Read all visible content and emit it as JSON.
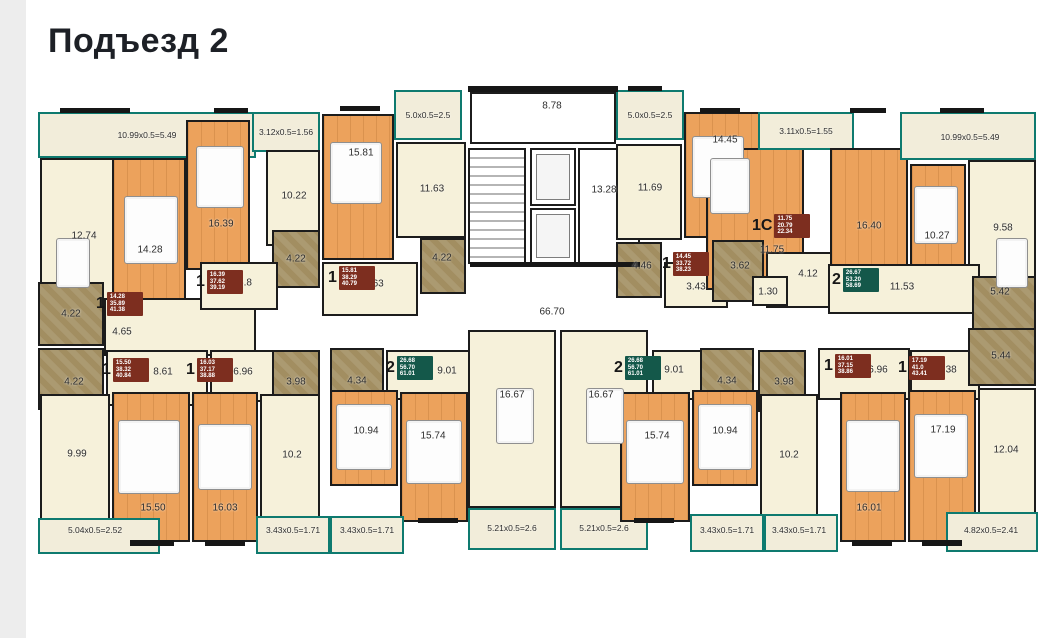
{
  "title": "Подъезд 2",
  "colors": {
    "teal_outline": "#0e7a6f",
    "wood_floor": "#eca25c",
    "kitchen_hall": "#f6f1da",
    "bathroom": "#a28e61",
    "wall": "#161616",
    "badge_red": "#7d2e1f",
    "badge_green": "#14584a"
  },
  "plan": {
    "rooms": [
      {
        "n": "balcony-a1",
        "l": "10.99x0.5=5.49",
        "t": "balcony",
        "x": 38,
        "y": 112,
        "w": 218,
        "h": 46
      },
      {
        "n": "kitchen-a1",
        "l": "12.74",
        "t": "cream",
        "x": 40,
        "y": 158,
        "w": 84,
        "h": 182,
        "lx": 84,
        "ly": 236
      },
      {
        "n": "bedroom-a1",
        "l": "14.28",
        "t": "wood",
        "x": 112,
        "y": 158,
        "w": 74,
        "h": 152,
        "lx": 150,
        "ly": 250
      },
      {
        "n": "hall-a1",
        "l": "4.65",
        "t": "cream",
        "x": 104,
        "y": 298,
        "w": 152,
        "h": 58,
        "lx": 122,
        "ly": 332
      },
      {
        "n": "bath-a1",
        "l": "4.22",
        "t": "bath",
        "x": 38,
        "y": 282,
        "w": 66,
        "h": 64
      },
      {
        "n": "bedroom-a2",
        "l": "16.39",
        "t": "wood",
        "x": 186,
        "y": 120,
        "w": 64,
        "h": 150,
        "lx": 221,
        "ly": 224
      },
      {
        "n": "balcony-a2",
        "l": "3.12x0.5=1.56",
        "t": "balcony",
        "x": 252,
        "y": 112,
        "w": 68,
        "h": 40
      },
      {
        "n": "kitchen-a2",
        "l": "10.22",
        "t": "cream",
        "x": 266,
        "y": 150,
        "w": 54,
        "h": 96,
        "lx": 294,
        "ly": 196
      },
      {
        "n": "bath-a2",
        "l": "4.22",
        "t": "bath",
        "x": 272,
        "y": 230,
        "w": 48,
        "h": 58
      },
      {
        "n": "hall-a2",
        "l": "6.8",
        "t": "cream",
        "x": 200,
        "y": 262,
        "w": 78,
        "h": 48,
        "lx": 245,
        "ly": 283
      },
      {
        "n": "bedroom-a3",
        "l": "15.81",
        "t": "wood",
        "x": 322,
        "y": 114,
        "w": 72,
        "h": 146,
        "lx": 361,
        "ly": 153
      },
      {
        "n": "balcony-a3",
        "l": "5.0x0.5=2.5",
        "t": "balcony",
        "x": 394,
        "y": 90,
        "w": 68,
        "h": 50
      },
      {
        "n": "kitchen-a3",
        "l": "11.63",
        "t": "cream",
        "x": 396,
        "y": 142,
        "w": 70,
        "h": 96,
        "lx": 432,
        "ly": 189
      },
      {
        "n": "bath-a3",
        "l": "4.22",
        "t": "bath",
        "x": 420,
        "y": 238,
        "w": 46,
        "h": 56,
        "lx": 442,
        "ly": 258
      },
      {
        "n": "hall-a3",
        "l": "6.63",
        "t": "cream",
        "x": 322,
        "y": 262,
        "w": 96,
        "h": 54,
        "lx": 374,
        "ly": 284
      },
      {
        "n": "entry-vestibule",
        "l": "8.78",
        "t": "core",
        "x": 470,
        "y": 92,
        "w": 146,
        "h": 52,
        "lx": 552,
        "ly": 106
      },
      {
        "n": "stairwell",
        "l": "",
        "t": "stairs",
        "x": 468,
        "y": 148,
        "w": 58,
        "h": 116
      },
      {
        "n": "elevator-1",
        "l": "",
        "t": "elevator",
        "x": 530,
        "y": 148,
        "w": 46,
        "h": 58
      },
      {
        "n": "elevator-2",
        "l": "",
        "t": "elevator",
        "x": 530,
        "y": 208,
        "w": 46,
        "h": 56
      },
      {
        "n": "elevator-hall",
        "l": "13.28",
        "t": "core",
        "x": 578,
        "y": 148,
        "w": 62,
        "h": 116,
        "lx": 604,
        "ly": 190
      },
      {
        "n": "balcony-a4",
        "l": "5.0x0.5=2.5",
        "t": "balcony",
        "x": 616,
        "y": 90,
        "w": 68,
        "h": 50
      },
      {
        "n": "kitchen-a4",
        "l": "11.69",
        "t": "cream",
        "x": 616,
        "y": 144,
        "w": 66,
        "h": 96,
        "lx": 650,
        "ly": 188
      },
      {
        "n": "bedroom-a4",
        "l": "14.45",
        "t": "wood",
        "x": 684,
        "y": 112,
        "w": 76,
        "h": 126,
        "lx": 725,
        "ly": 140
      },
      {
        "n": "bath-a4",
        "l": "4.46",
        "t": "bath",
        "x": 616,
        "y": 242,
        "w": 46,
        "h": 56,
        "lx": 642,
        "ly": 266
      },
      {
        "n": "hall-a4",
        "l": "3.43",
        "t": "cream",
        "x": 664,
        "y": 262,
        "w": 64,
        "h": 46,
        "lx": 696,
        "ly": 287
      },
      {
        "n": "studio-a5",
        "l": "",
        "t": "wood",
        "x": 706,
        "y": 148,
        "w": 98,
        "h": 142
      },
      {
        "n": "balcony-a5",
        "l": "3.11x0.5=1.55",
        "t": "balcony",
        "x": 758,
        "y": 112,
        "w": 96,
        "h": 38
      },
      {
        "n": "bath-a5",
        "l": "3.62",
        "t": "bath",
        "x": 712,
        "y": 240,
        "w": 52,
        "h": 62,
        "lx": 740,
        "ly": 266
      },
      {
        "n": "hall-a5",
        "l": "4.12",
        "t": "cream",
        "x": 766,
        "y": 252,
        "w": 88,
        "h": 56,
        "lx": 808,
        "ly": 274
      },
      {
        "n": "wc-a5",
        "l": "1.30",
        "t": "cream",
        "x": 752,
        "y": 276,
        "w": 36,
        "h": 30,
        "lx": 768,
        "ly": 292
      },
      {
        "n": "living-a6",
        "l": "16.40",
        "t": "wood",
        "x": 830,
        "y": 148,
        "w": 78,
        "h": 130,
        "lx": 869,
        "ly": 226
      },
      {
        "n": "bedroom-a6",
        "l": "10.27",
        "t": "wood",
        "x": 910,
        "y": 164,
        "w": 56,
        "h": 136,
        "lx": 937,
        "ly": 236
      },
      {
        "n": "balcony-a6",
        "l": "10.99x0.5=5.49",
        "t": "balcony",
        "x": 900,
        "y": 112,
        "w": 136,
        "h": 48,
        "lx": 970,
        "ly": 137
      },
      {
        "n": "kitchen-a6",
        "l": "9.58",
        "t": "cream",
        "x": 968,
        "y": 160,
        "w": 68,
        "h": 142,
        "lx": 1003,
        "ly": 228
      },
      {
        "n": "hall-a6",
        "l": "11.53",
        "t": "cream",
        "x": 828,
        "y": 264,
        "w": 152,
        "h": 50,
        "lx": 902,
        "ly": 287
      },
      {
        "n": "bath-a6",
        "l": "5.42",
        "t": "bath",
        "x": 972,
        "y": 276,
        "w": 64,
        "h": 54,
        "lx": 1000,
        "ly": 292
      },
      {
        "n": "bath-b1",
        "l": "4.22",
        "t": "bath",
        "x": 38,
        "y": 348,
        "w": 66,
        "h": 62,
        "lx": 74,
        "ly": 382
      },
      {
        "n": "hall-b1",
        "l": "8.61",
        "t": "cream",
        "x": 106,
        "y": 350,
        "w": 102,
        "h": 56,
        "lx": 163,
        "ly": 372
      },
      {
        "n": "hall-b2",
        "l": "6.96",
        "t": "cream",
        "x": 210,
        "y": 350,
        "w": 86,
        "h": 52,
        "lx": 243,
        "ly": 372
      },
      {
        "n": "bath-b2",
        "l": "3.98",
        "t": "bath",
        "x": 272,
        "y": 350,
        "w": 48,
        "h": 62,
        "lx": 296,
        "ly": 382
      },
      {
        "n": "bath-c1",
        "l": "4.34",
        "t": "bath",
        "x": 330,
        "y": 348,
        "w": 54,
        "h": 64,
        "lx": 357,
        "ly": 381
      },
      {
        "n": "hall-c1",
        "l": "9.01",
        "t": "cream",
        "x": 386,
        "y": 350,
        "w": 92,
        "h": 50,
        "lx": 447,
        "ly": 371
      },
      {
        "n": "greatroom-c1",
        "l": "16.67",
        "t": "cream",
        "x": 468,
        "y": 330,
        "w": 88,
        "h": 178,
        "lx": 512,
        "ly": 395
      },
      {
        "n": "greatroom-c2",
        "l": "16.67",
        "t": "cream",
        "x": 560,
        "y": 330,
        "w": 88,
        "h": 178,
        "lx": 601,
        "ly": 395
      },
      {
        "n": "balcony-c1",
        "l": "5.21x0.5=2.6",
        "t": "balcony",
        "x": 468,
        "y": 508,
        "w": 88,
        "h": 42,
        "lx": 512,
        "ly": 528
      },
      {
        "n": "balcony-c2",
        "l": "5.21x0.5=2.6",
        "t": "balcony",
        "x": 560,
        "y": 508,
        "w": 88,
        "h": 42,
        "lx": 604,
        "ly": 528
      },
      {
        "n": "hall-c2",
        "l": "9.01",
        "t": "cream",
        "x": 652,
        "y": 350,
        "w": 92,
        "h": 50,
        "lx": 674,
        "ly": 370
      },
      {
        "n": "bath-c2",
        "l": "4.34",
        "t": "bath",
        "x": 700,
        "y": 348,
        "w": 54,
        "h": 64,
        "lx": 727,
        "ly": 381
      },
      {
        "n": "bath-b3",
        "l": "3.98",
        "t": "bath",
        "x": 758,
        "y": 350,
        "w": 48,
        "h": 62,
        "lx": 784,
        "ly": 382
      },
      {
        "n": "hall-b3",
        "l": "6.96",
        "t": "cream",
        "x": 818,
        "y": 348,
        "w": 92,
        "h": 52,
        "lx": 878,
        "ly": 370
      },
      {
        "n": "hall-b4",
        "l": "6.38",
        "t": "cream",
        "x": 910,
        "y": 350,
        "w": 70,
        "h": 50,
        "lx": 947,
        "ly": 370
      },
      {
        "n": "bath-b4",
        "l": "5.44",
        "t": "bath",
        "x": 968,
        "y": 328,
        "w": 68,
        "h": 58,
        "lx": 1001,
        "ly": 356
      },
      {
        "n": "kitchen-b1",
        "l": "9.99",
        "t": "cream",
        "x": 40,
        "y": 394,
        "w": 70,
        "h": 126,
        "lx": 77,
        "ly": 454
      },
      {
        "n": "bedroom-b1",
        "l": "15.50",
        "t": "wood",
        "x": 112,
        "y": 392,
        "w": 78,
        "h": 150,
        "lx": 153,
        "ly": 508
      },
      {
        "n": "bedroom-b2",
        "l": "16.03",
        "t": "wood",
        "x": 192,
        "y": 392,
        "w": 66,
        "h": 150,
        "lx": 225,
        "ly": 508
      },
      {
        "n": "kitchen-b2",
        "l": "10.2",
        "t": "cream",
        "x": 260,
        "y": 394,
        "w": 60,
        "h": 126,
        "lx": 292,
        "ly": 455
      },
      {
        "n": "bedroom-c1",
        "l": "10.94",
        "t": "wood",
        "x": 330,
        "y": 390,
        "w": 68,
        "h": 96,
        "lx": 366,
        "ly": 431
      },
      {
        "n": "living-c1",
        "l": "15.74",
        "t": "wood",
        "x": 400,
        "y": 392,
        "w": 68,
        "h": 130,
        "lx": 433,
        "ly": 436
      },
      {
        "n": "living-c2",
        "l": "15.74",
        "t": "wood",
        "x": 620,
        "y": 392,
        "w": 70,
        "h": 130,
        "lx": 657,
        "ly": 436
      },
      {
        "n": "bedroom-c2",
        "l": "10.94",
        "t": "wood",
        "x": 692,
        "y": 390,
        "w": 66,
        "h": 96,
        "lx": 725,
        "ly": 431
      },
      {
        "n": "kitchen-c2",
        "l": "10.2",
        "t": "cream",
        "x": 760,
        "y": 394,
        "w": 58,
        "h": 126,
        "lx": 789,
        "ly": 455
      },
      {
        "n": "bedroom-b3",
        "l": "16.01",
        "t": "wood",
        "x": 840,
        "y": 392,
        "w": 66,
        "h": 150,
        "lx": 869,
        "ly": 508
      },
      {
        "n": "room-b4",
        "l": "17.19",
        "t": "wood",
        "x": 908,
        "y": 390,
        "w": 68,
        "h": 152,
        "lx": 943,
        "ly": 430
      },
      {
        "n": "kitchen-b4",
        "l": "12.04",
        "t": "cream",
        "x": 978,
        "y": 388,
        "w": 58,
        "h": 132,
        "lx": 1006,
        "ly": 450
      },
      {
        "n": "balcony-b1",
        "l": "5.04x0.5=2.52",
        "t": "balcony",
        "x": 38,
        "y": 518,
        "w": 122,
        "h": 36,
        "lx": 95,
        "ly": 530
      },
      {
        "n": "balcony-b2",
        "l": "3.43x0.5=1.71",
        "t": "balcony",
        "x": 256,
        "y": 516,
        "w": 74,
        "h": 38,
        "lx": 293,
        "ly": 530
      },
      {
        "n": "balcony-c1l",
        "l": "3.43x0.5=1.71",
        "t": "balcony",
        "x": 330,
        "y": 516,
        "w": 74,
        "h": 38,
        "lx": 367,
        "ly": 530
      },
      {
        "n": "balcony-c2r",
        "l": "3.43x0.5=1.71",
        "t": "balcony",
        "x": 690,
        "y": 514,
        "w": 74,
        "h": 38,
        "lx": 727,
        "ly": 530
      },
      {
        "n": "balcony-b3",
        "l": "3.43x0.5=1.71",
        "t": "balcony",
        "x": 764,
        "y": 514,
        "w": 74,
        "h": 38,
        "lx": 799,
        "ly": 530
      },
      {
        "n": "balcony-b4",
        "l": "4.82x0.5=2.41",
        "t": "balcony",
        "x": 946,
        "y": 512,
        "w": 92,
        "h": 40,
        "lx": 991,
        "ly": 530
      }
    ],
    "labels": [
      {
        "n": "corridor-area",
        "text": "66.70",
        "x": 552,
        "y": 312
      },
      {
        "n": "studio-a5-area",
        "text": "11.75",
        "x": 772,
        "y": 250
      }
    ],
    "badges": [
      {
        "n": "apt-badge-1",
        "x": 96,
        "y": 292,
        "big": "1",
        "c": "red",
        "lines": [
          "14.28",
          "35.89",
          "41.38"
        ]
      },
      {
        "n": "apt-badge-2",
        "x": 196,
        "y": 270,
        "big": "1",
        "c": "red",
        "lines": [
          "16.39",
          "37.62",
          "39.19"
        ]
      },
      {
        "n": "apt-badge-3",
        "x": 328,
        "y": 266,
        "big": "1",
        "c": "red",
        "lines": [
          "15.81",
          "38.29",
          "40.79"
        ]
      },
      {
        "n": "apt-badge-4",
        "x": 662,
        "y": 252,
        "big": "1",
        "c": "red",
        "lines": [
          "14.45",
          "33.72",
          "38.23"
        ]
      },
      {
        "n": "apt-badge-5",
        "x": 752,
        "y": 214,
        "big": "1С",
        "c": "red",
        "lines": [
          "11.75",
          "20.79",
          "22.34"
        ]
      },
      {
        "n": "apt-badge-6",
        "x": 832,
        "y": 268,
        "big": "2",
        "c": "green",
        "lines": [
          "26.67",
          "53.20",
          "58.69"
        ]
      },
      {
        "n": "apt-badge-7",
        "x": 102,
        "y": 358,
        "big": "1",
        "c": "red",
        "lines": [
          "15.50",
          "38.32",
          "40.84"
        ]
      },
      {
        "n": "apt-badge-8",
        "x": 186,
        "y": 358,
        "big": "1",
        "c": "red",
        "lines": [
          "16.03",
          "37.17",
          "38.88"
        ]
      },
      {
        "n": "apt-badge-9",
        "x": 386,
        "y": 356,
        "big": "2",
        "c": "green",
        "lines": [
          "26.68",
          "56.70",
          "61.01"
        ]
      },
      {
        "n": "apt-badge-10",
        "x": 614,
        "y": 356,
        "big": "2",
        "c": "green",
        "lines": [
          "26.68",
          "56.70",
          "61.01"
        ]
      },
      {
        "n": "apt-badge-11",
        "x": 824,
        "y": 354,
        "big": "1",
        "c": "red",
        "lines": [
          "16.01",
          "37.15",
          "38.86"
        ]
      },
      {
        "n": "apt-badge-12",
        "x": 898,
        "y": 356,
        "big": "1",
        "c": "red",
        "lines": [
          "17.19",
          "41.0",
          "43.41"
        ]
      }
    ],
    "walls": [
      {
        "x": 60,
        "y": 108,
        "w": 70,
        "h": 5
      },
      {
        "x": 214,
        "y": 108,
        "w": 34,
        "h": 5
      },
      {
        "x": 340,
        "y": 106,
        "w": 40,
        "h": 5
      },
      {
        "x": 628,
        "y": 86,
        "w": 34,
        "h": 5
      },
      {
        "x": 700,
        "y": 108,
        "w": 40,
        "h": 5
      },
      {
        "x": 850,
        "y": 108,
        "w": 36,
        "h": 5
      },
      {
        "x": 940,
        "y": 108,
        "w": 44,
        "h": 5
      },
      {
        "x": 468,
        "y": 86,
        "w": 150,
        "h": 6
      },
      {
        "x": 470,
        "y": 262,
        "w": 170,
        "h": 5
      },
      {
        "x": 130,
        "y": 540,
        "w": 44,
        "h": 6
      },
      {
        "x": 205,
        "y": 540,
        "w": 40,
        "h": 6
      },
      {
        "x": 418,
        "y": 518,
        "w": 40,
        "h": 5
      },
      {
        "x": 634,
        "y": 518,
        "w": 40,
        "h": 5
      },
      {
        "x": 852,
        "y": 540,
        "w": 40,
        "h": 6
      },
      {
        "x": 922,
        "y": 540,
        "w": 40,
        "h": 6
      }
    ],
    "furniture": [
      {
        "n": "bed",
        "x": 124,
        "y": 196,
        "w": 52,
        "h": 66
      },
      {
        "n": "bed",
        "x": 196,
        "y": 146,
        "w": 46,
        "h": 60
      },
      {
        "n": "bed",
        "x": 330,
        "y": 142,
        "w": 50,
        "h": 60
      },
      {
        "n": "bed",
        "x": 692,
        "y": 136,
        "w": 50,
        "h": 60
      },
      {
        "n": "bed",
        "x": 914,
        "y": 186,
        "w": 42,
        "h": 56
      },
      {
        "n": "sofa",
        "x": 710,
        "y": 158,
        "w": 38,
        "h": 54
      },
      {
        "n": "bed",
        "x": 118,
        "y": 420,
        "w": 60,
        "h": 72
      },
      {
        "n": "sofa",
        "x": 198,
        "y": 424,
        "w": 52,
        "h": 64
      },
      {
        "n": "bed",
        "x": 336,
        "y": 404,
        "w": 54,
        "h": 64
      },
      {
        "n": "sofa",
        "x": 406,
        "y": 420,
        "w": 54,
        "h": 62
      },
      {
        "n": "sofa",
        "x": 626,
        "y": 420,
        "w": 56,
        "h": 62
      },
      {
        "n": "bed",
        "x": 698,
        "y": 404,
        "w": 52,
        "h": 64
      },
      {
        "n": "bed",
        "x": 846,
        "y": 420,
        "w": 52,
        "h": 70
      },
      {
        "n": "desk",
        "x": 914,
        "y": 414,
        "w": 52,
        "h": 62
      },
      {
        "n": "table",
        "x": 496,
        "y": 388,
        "w": 36,
        "h": 54
      },
      {
        "n": "table",
        "x": 586,
        "y": 388,
        "w": 36,
        "h": 54
      },
      {
        "n": "table",
        "x": 56,
        "y": 238,
        "w": 32,
        "h": 48
      },
      {
        "n": "table",
        "x": 996,
        "y": 238,
        "w": 30,
        "h": 48
      }
    ]
  }
}
